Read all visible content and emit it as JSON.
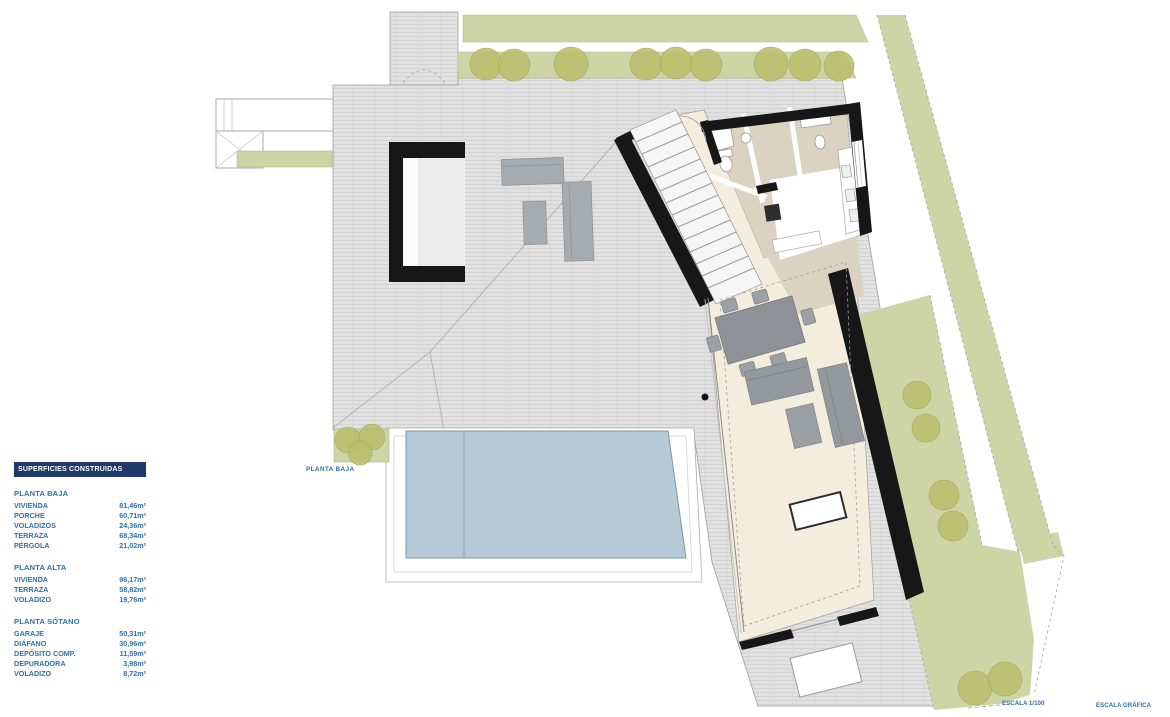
{
  "legend": {
    "title": "SUPERFICIES CONSTRUIDAS",
    "sections": [
      {
        "title": "PLANTA BAJA",
        "rows": [
          {
            "label": "VIVIENDA",
            "value": "81,46m²"
          },
          {
            "label": "PORCHE",
            "value": "60,71m²"
          },
          {
            "label": "VOLADIZOS",
            "value": "24,36m²"
          },
          {
            "label": "TERRAZA",
            "value": "68,34m²"
          },
          {
            "label": "PÉRGOLA",
            "value": "21,02m²"
          }
        ]
      },
      {
        "title": "PLANTA ALTA",
        "rows": [
          {
            "label": "VIVIENDA",
            "value": "96,17m²"
          },
          {
            "label": "TERRAZA",
            "value": "58,82m²"
          },
          {
            "label": "VOLADIZO",
            "value": "19,76m²"
          }
        ]
      },
      {
        "title": "PLANTA SÓTANO",
        "rows": [
          {
            "label": "GARAJE",
            "value": "50,31m²"
          },
          {
            "label": "DIÁFANO",
            "value": "30,96m²"
          },
          {
            "label": "DEPÓSITO COMP.",
            "value": "11,59m²"
          },
          {
            "label": "DEPURADORA",
            "value": "3,98m²"
          },
          {
            "label": "VOLADIZO",
            "value": "8,72m²"
          }
        ]
      }
    ]
  },
  "plan": {
    "label": "PLANTA BAJA",
    "scale_label": "ESCALA  1/100",
    "graphic_scale_label": "ESCALA GRÁFICA"
  },
  "colors": {
    "legend_header_bg": "#1f3a68",
    "text_blue": "#2e6fad",
    "roof_gray": "#e1e1e1",
    "wall_black": "#171717",
    "grass_green": "#cdd4a6",
    "tree_olive": "#babe6c",
    "pool_blue": "#b5c9d7",
    "floor_cream": "#f4ecdc",
    "floor_taupe": "#dbd2c2",
    "furniture_gray": "#93989c"
  }
}
